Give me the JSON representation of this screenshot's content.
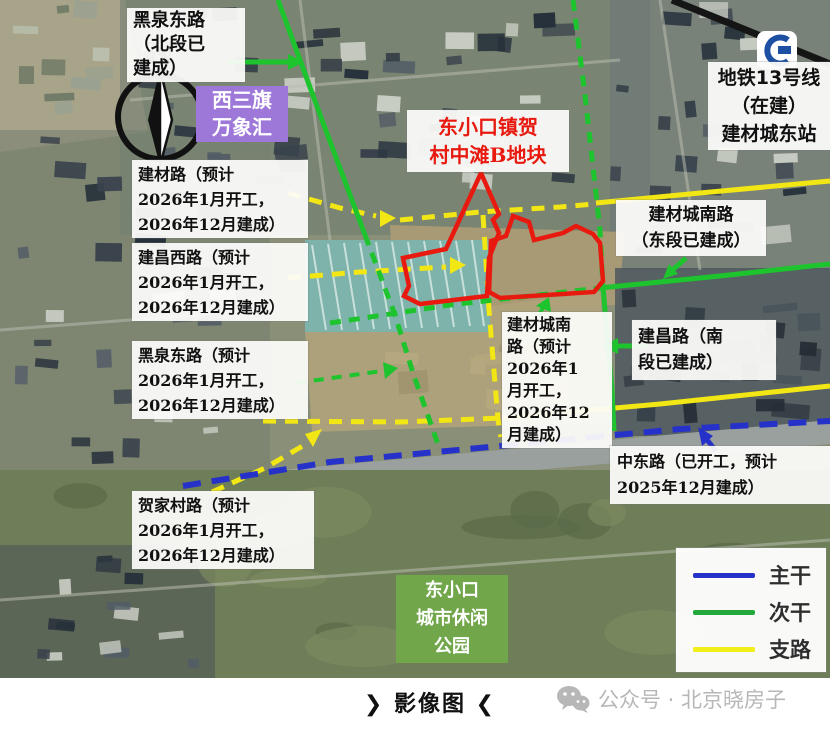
{
  "labels": {
    "heiquan_north": {
      "text": "黑泉东路\n（北段已\n建成）"
    },
    "xisanqi": {
      "text": "西三旗\n万象汇"
    },
    "jiancai": {
      "text": "建材路（预计\n2026年1月开工，\n2026年12月建成）"
    },
    "jianchang_west": {
      "text": "建昌西路（预计\n2026年1月开工，\n2026年12月建成）"
    },
    "heiquan_south": {
      "text": "黑泉东路（预计\n2026年1月开工，\n2026年12月建成）"
    },
    "hejiacun": {
      "text": "贺家村路（预计\n2026年1月开工，\n2026年12月建成）"
    },
    "plot": {
      "text": "东小口镇贺\n村中滩B地块"
    },
    "metro": {
      "text": "地铁13号线\n（在建）\n建材城东站"
    },
    "jccn_east": {
      "text": "建材城南路\n（东段已建成）"
    },
    "jianchang_south": {
      "text": "建昌路（南\n段已建成）"
    },
    "jccn_center": {
      "text": "建材城南\n路（预计\n2026年1\n月开工，\n2026年12\n月建成）"
    },
    "zhongdong": {
      "text": "中东路（已开工，预计\n2025年12月建成）"
    },
    "park": {
      "text": "东小口\n城市休闲\n公园"
    }
  },
  "compass": {
    "letter": "N"
  },
  "legend": {
    "items": [
      {
        "label": "主干",
        "color": "#2531c8"
      },
      {
        "label": "次干",
        "color": "#23a83c"
      },
      {
        "label": "支路",
        "color": "#f2ee18"
      }
    ]
  },
  "caption": "❯ 影像图 ❮",
  "watermark": "公众号 · 北京晓房子",
  "colors": {
    "plot_outline": "#e8190f",
    "road_trunk_blue": "#2531c8",
    "road_secondary_green": "#1ec42e",
    "road_branch_yellow": "#f2e714",
    "railway_black": "#151515",
    "metro_logo_blue": "#1d50a2",
    "mall_purple": "#9e78d8",
    "park_green": "#71a64b"
  }
}
